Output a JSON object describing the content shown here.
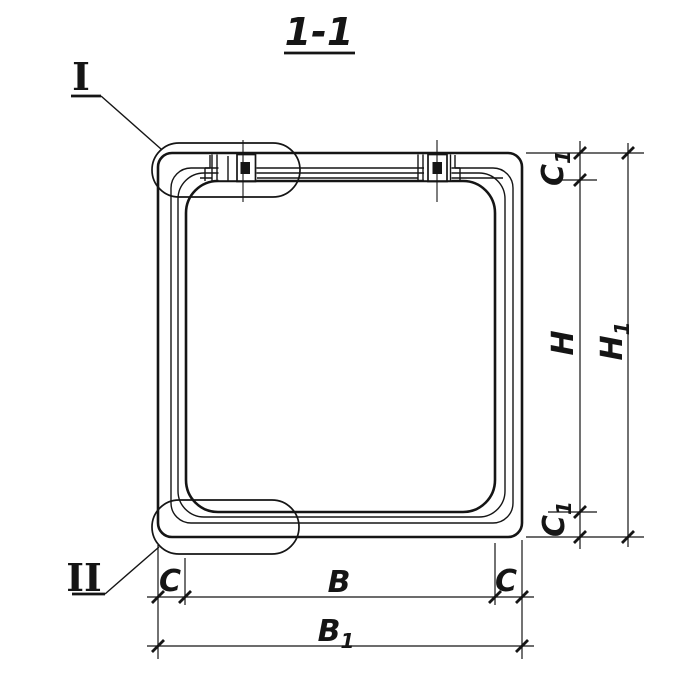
{
  "title": {
    "text": "1-1"
  },
  "markers": {
    "detail_1": {
      "label": "I"
    },
    "detail_2": {
      "label": "II"
    }
  },
  "dims": {
    "c1_top": {
      "base": "C",
      "sub": "1"
    },
    "h": {
      "base": "H",
      "sub": ""
    },
    "h1": {
      "base": "H",
      "sub": "1"
    },
    "c1_bottom": {
      "base": "C",
      "sub": "1"
    },
    "c_left": {
      "base": "C",
      "sub": ""
    },
    "b": {
      "base": "B",
      "sub": ""
    },
    "c_right": {
      "base": "C",
      "sub": ""
    },
    "b1": {
      "base": "B",
      "sub": "1"
    }
  },
  "colors": {
    "ink": "#151515",
    "paper": "#ffffff"
  }
}
